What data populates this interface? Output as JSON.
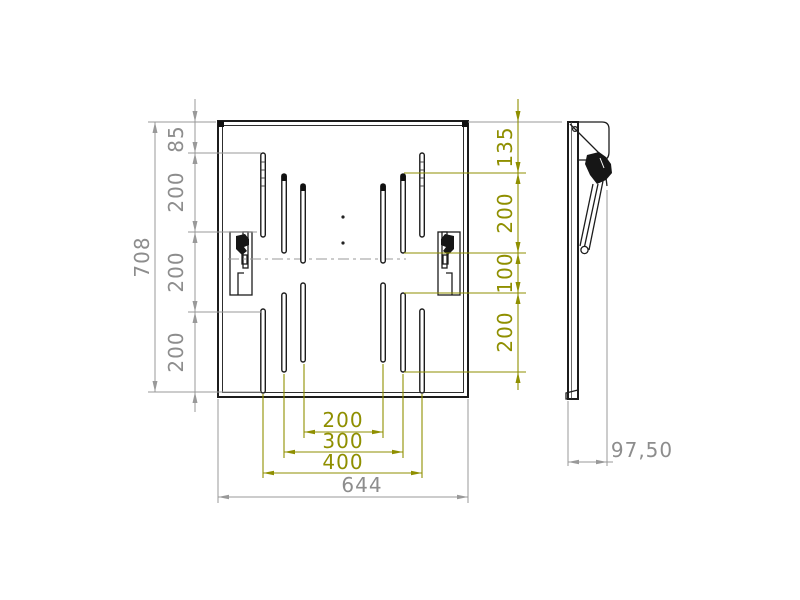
{
  "drawing": {
    "type": "technical-orthographic-views",
    "views": [
      "front-view-plate",
      "side-profile-view"
    ]
  },
  "dims": {
    "left": [
      {
        "name": "plate-total-height",
        "value": "708"
      },
      {
        "name": "top-edge-to-first-slot",
        "value": "85"
      },
      {
        "name": "vertical-pitch-1",
        "value": "200"
      },
      {
        "name": "vertical-pitch-2",
        "value": "200"
      },
      {
        "name": "vertical-pitch-3",
        "value": "200"
      }
    ],
    "right": [
      {
        "name": "top-edge-to-slot-top",
        "value": "135"
      },
      {
        "name": "upper-slot-length",
        "value": "200"
      },
      {
        "name": "slot-gap",
        "value": "100"
      },
      {
        "name": "lower-slot-length",
        "value": "200"
      }
    ],
    "bottom": [
      {
        "name": "inner-slot-span",
        "value": "200"
      },
      {
        "name": "middle-slot-span",
        "value": "300"
      },
      {
        "name": "outer-slot-span",
        "value": "400"
      },
      {
        "name": "plate-total-width",
        "value": "644"
      }
    ],
    "side": [
      {
        "name": "profile-depth",
        "value": "97,50"
      }
    ]
  },
  "colors": {
    "line_black": "#1c1c1c",
    "dim_gray": "#8d8d8d",
    "dim_olive": "#8f8f00",
    "background": "#ffffff"
  }
}
